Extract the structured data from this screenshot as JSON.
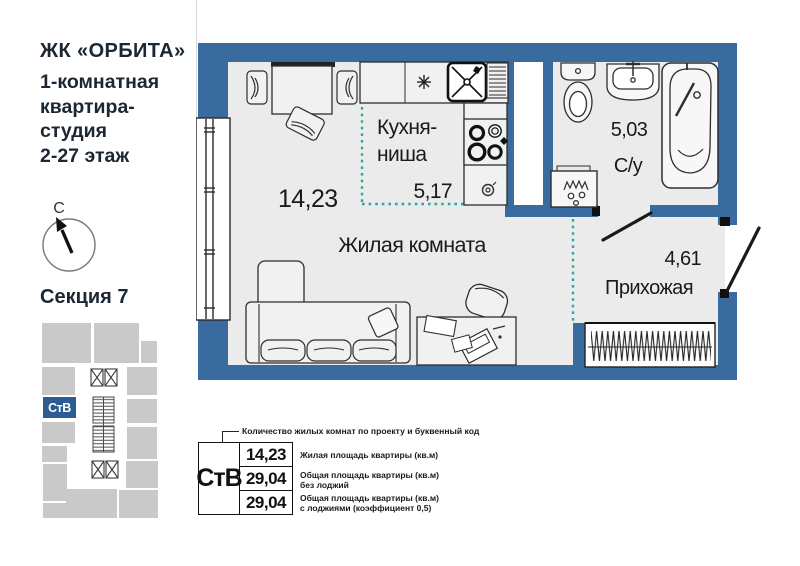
{
  "header": {
    "complex": "ЖК «ОРБИТА»",
    "subtitle_line1": "1-комнатная",
    "subtitle_line2": "квартира-",
    "subtitle_line3": "студия",
    "subtitle_line4": "2-27 этаж"
  },
  "compass": {
    "north_label": "С"
  },
  "section": {
    "title": "Секция 7",
    "unit_code": "СтВ"
  },
  "plan": {
    "living_area": "14,23",
    "kitchen_label_line1": "Кухня-",
    "kitchen_label_line2": "ниша",
    "kitchen_area": "5,17",
    "living_label": "Жилая комната",
    "bath_area": "5,03",
    "bath_label": "С/у",
    "hall_area": "4,61",
    "hall_label": "Прихожая"
  },
  "legend": {
    "callout": "Количество жилых комнат по проекту и буквенный код",
    "unit_code": "СтВ",
    "rows": [
      {
        "value": "14,23",
        "desc": "Жилая площадь квартиры (кв.м)",
        "desc2": ""
      },
      {
        "value": "29,04",
        "desc": "Общая площадь квартиры (кв.м)",
        "desc2": "без лоджий"
      },
      {
        "value": "29,04",
        "desc": "Общая площадь квартиры (кв.м)",
        "desc2": "с лоджиями (коэффициент 0,5)"
      }
    ]
  },
  "colors": {
    "wall_blue": "#3a6b9e",
    "accent_teal": "#28aaa0",
    "minimap_highlight": "#2b5c92",
    "floor": "#ebebeb"
  }
}
